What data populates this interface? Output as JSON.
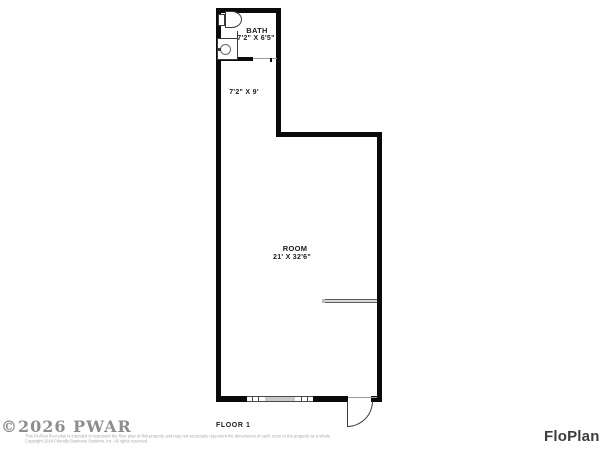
{
  "plan": {
    "floor_label": "FLOOR 1",
    "rooms": {
      "bath": {
        "name": "BATH",
        "dims": "7'2\" X 6'5\""
      },
      "hall": {
        "dims": "7'2\" X 9'"
      },
      "room": {
        "name": "ROOM",
        "dims": "21' X 32'6\""
      }
    },
    "fixtures": [
      "toilet-icon",
      "sink-vanity-icon",
      "window-symbol",
      "door-swing-symbol",
      "half-wall"
    ]
  },
  "footer": {
    "watermark": "©2026 PWAR",
    "disclaimer_line1": "This FloPlan floor plan is intended to represent the floor plan of this property and may not accurately represent the dimensions of each room or the property as a whole.",
    "disclaimer_line2": "Copyright 2024 Friendly Business Systems, Inc. All rights reserved.",
    "brand": "FloPlan"
  },
  "colors": {
    "wall": "#0a0a0a",
    "fixture_outline": "#3a3a3a",
    "window_fill": "#c9c9c9",
    "watermark": "#8d8d8d",
    "brand": "#3d3d3d",
    "background": "#ffffff"
  }
}
